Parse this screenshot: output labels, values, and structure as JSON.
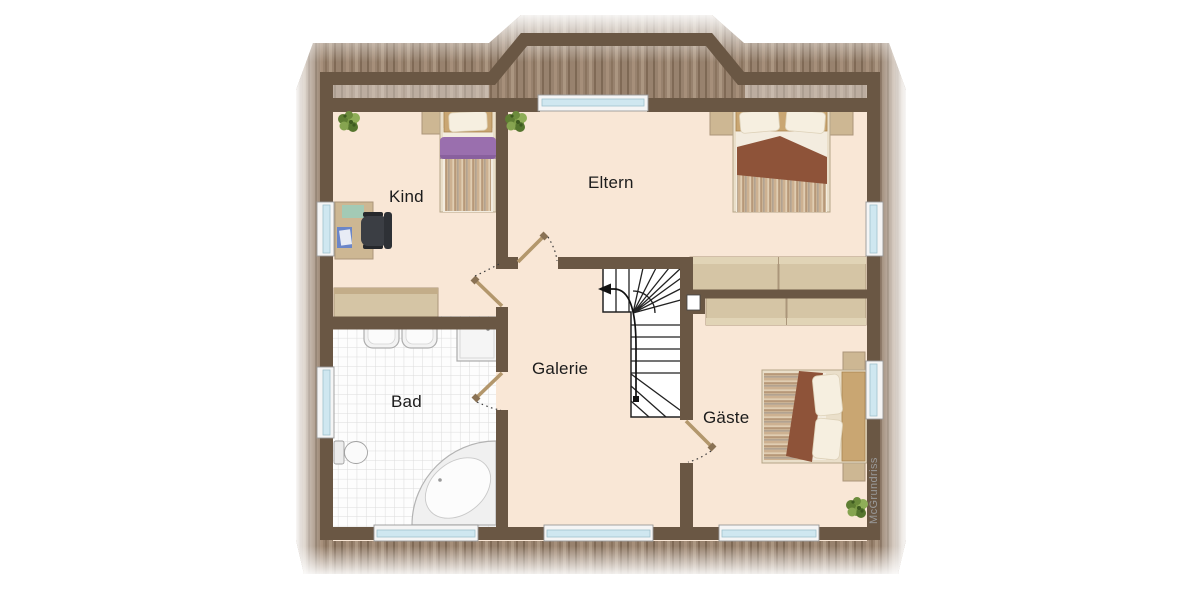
{
  "rooms": [
    {
      "id": "kind",
      "label": "Kind"
    },
    {
      "id": "eltern",
      "label": "Eltern"
    },
    {
      "id": "bad",
      "label": "Bad"
    },
    {
      "id": "galerie",
      "label": "Galerie"
    },
    {
      "id": "gaeste",
      "label": "Gäste"
    }
  ],
  "watermark": {
    "text": "McGrundriss"
  },
  "palette": {
    "wall": "#6a5744",
    "room_floor": "#f9e7d6",
    "roof_wood": "#98826e",
    "furniture_wood": "#d5c5a5",
    "desk_wood": "#cdb793",
    "headboard": "#c9a672",
    "blanket_brown": "#8e5339",
    "blanket_purple": "#9a6fae",
    "bed_frame": "#eadfca",
    "window_glass": "#cfe7f0",
    "tile_line": "#dcdcdc",
    "stair_line": "#222222",
    "door_leaf": "#b3976c",
    "label_text": "#1c1c1c",
    "plant_green": "#7b9a46"
  },
  "fixtures": [
    "single-bed",
    "double-bed",
    "guest-double-bed",
    "desk",
    "office-chair",
    "sideboard",
    "nightstand",
    "wardrobe-eltern",
    "wardrobe-gaeste",
    "washbasin",
    "washbasin",
    "shower",
    "toilet",
    "corner-bathtub",
    "winder-staircase",
    "potted-plant",
    "dormer-window"
  ]
}
